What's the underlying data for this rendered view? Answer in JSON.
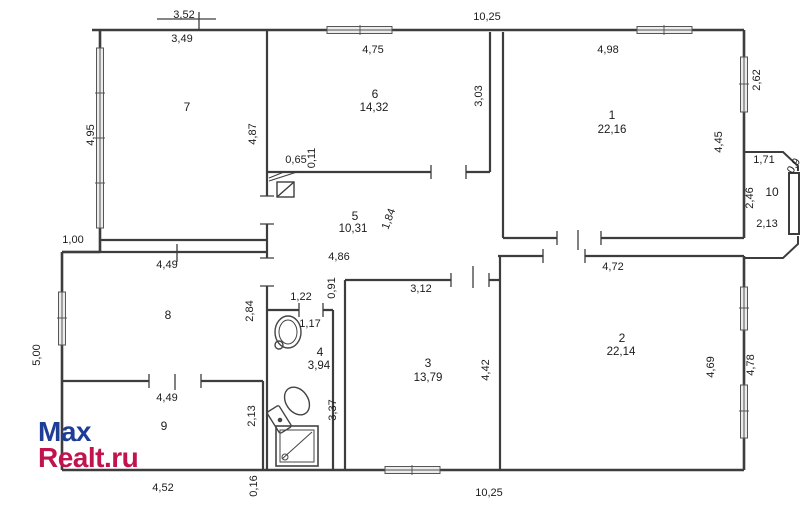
{
  "colors": {
    "wall": "#3d3d3d",
    "label_text": "#1c1c1c",
    "watermark_blue": "#1e3d96",
    "watermark_red": "#c1134e"
  },
  "watermark": {
    "line1": "Max",
    "line2": "Realt.ru"
  },
  "floorplan": {
    "rooms": [
      {
        "number": "1",
        "area": "22,16"
      },
      {
        "number": "2",
        "area": "22,14"
      },
      {
        "number": "3",
        "area": "13,79"
      },
      {
        "number": "4",
        "area": "3,94"
      },
      {
        "number": "5",
        "area": "10,31"
      },
      {
        "number": "6",
        "area": "14,32"
      },
      {
        "number": "7",
        "area": ""
      },
      {
        "number": "8",
        "area": ""
      },
      {
        "number": "9",
        "area": ""
      },
      {
        "number": "10",
        "area": ""
      }
    ],
    "labels": [
      {
        "text": "7",
        "x": 187,
        "y": 107,
        "rot": 0,
        "kind": "room"
      },
      {
        "text": "6",
        "x": 375,
        "y": 94,
        "rot": 0,
        "kind": "room"
      },
      {
        "text": "14,32",
        "x": 374,
        "y": 108,
        "rot": 0,
        "kind": "area"
      },
      {
        "text": "1",
        "x": 612,
        "y": 115,
        "rot": 0,
        "kind": "room"
      },
      {
        "text": "22,16",
        "x": 612,
        "y": 130,
        "rot": 0,
        "kind": "area"
      },
      {
        "text": "5",
        "x": 355,
        "y": 216,
        "rot": 0,
        "kind": "room"
      },
      {
        "text": "10,31",
        "x": 353,
        "y": 229,
        "rot": 0,
        "kind": "area"
      },
      {
        "text": "8",
        "x": 168,
        "y": 315,
        "rot": 0,
        "kind": "room"
      },
      {
        "text": "9",
        "x": 164,
        "y": 426,
        "rot": 0,
        "kind": "room"
      },
      {
        "text": "4",
        "x": 320,
        "y": 352,
        "rot": 0,
        "kind": "room"
      },
      {
        "text": "3,94",
        "x": 319,
        "y": 366,
        "rot": 0,
        "kind": "area"
      },
      {
        "text": "3",
        "x": 428,
        "y": 363,
        "rot": 0,
        "kind": "room"
      },
      {
        "text": "13,79",
        "x": 428,
        "y": 378,
        "rot": 0,
        "kind": "area"
      },
      {
        "text": "2",
        "x": 622,
        "y": 338,
        "rot": 0,
        "kind": "room"
      },
      {
        "text": "22,14",
        "x": 621,
        "y": 352,
        "rot": 0,
        "kind": "area"
      },
      {
        "text": "10",
        "x": 772,
        "y": 192,
        "rot": 0,
        "kind": "room"
      },
      {
        "text": "3,52",
        "x": 184,
        "y": 15,
        "rot": 0,
        "kind": "dim"
      },
      {
        "text": "10,25",
        "x": 487,
        "y": 17,
        "rot": 0,
        "kind": "dim"
      },
      {
        "text": "3,49",
        "x": 182,
        "y": 39,
        "rot": 0,
        "kind": "dim"
      },
      {
        "text": "4,75",
        "x": 373,
        "y": 50,
        "rot": 0,
        "kind": "dim"
      },
      {
        "text": "4,98",
        "x": 608,
        "y": 50,
        "rot": 0,
        "kind": "dim"
      },
      {
        "text": "4,95",
        "x": 91,
        "y": 135,
        "rot": -90,
        "kind": "dim"
      },
      {
        "text": "4,87",
        "x": 253,
        "y": 134,
        "rot": -90,
        "kind": "dim"
      },
      {
        "text": "3,03",
        "x": 479,
        "y": 96,
        "rot": -90,
        "kind": "dim"
      },
      {
        "text": "4,45",
        "x": 719,
        "y": 142,
        "rot": -90,
        "kind": "dim"
      },
      {
        "text": "2,62",
        "x": 757,
        "y": 80,
        "rot": -90,
        "kind": "dim"
      },
      {
        "text": "0,65",
        "x": 296,
        "y": 160,
        "rot": 0,
        "kind": "dim"
      },
      {
        "text": "0,11",
        "x": 312,
        "y": 158,
        "rot": -90,
        "kind": "dim"
      },
      {
        "text": "1,84",
        "x": 389,
        "y": 219,
        "rot": -70,
        "kind": "dim"
      },
      {
        "text": "1,71",
        "x": 764,
        "y": 160,
        "rot": 0,
        "kind": "dim"
      },
      {
        "text": "2,46",
        "x": 750,
        "y": 198,
        "rot": -90,
        "kind": "dim"
      },
      {
        "text": "2,13",
        "x": 767,
        "y": 224,
        "rot": 0,
        "kind": "dim"
      },
      {
        "text": "0,9",
        "x": 794,
        "y": 166,
        "rot": -58,
        "kind": "dim"
      },
      {
        "text": "1,00",
        "x": 73,
        "y": 240,
        "rot": 0,
        "kind": "dim"
      },
      {
        "text": "4,49",
        "x": 167,
        "y": 265,
        "rot": 0,
        "kind": "dim"
      },
      {
        "text": "2,84",
        "x": 250,
        "y": 311,
        "rot": -90,
        "kind": "dim"
      },
      {
        "text": "5,00",
        "x": 37,
        "y": 355,
        "rot": -90,
        "kind": "dim"
      },
      {
        "text": "4,86",
        "x": 339,
        "y": 257,
        "rot": 0,
        "kind": "dim"
      },
      {
        "text": "0,91",
        "x": 332,
        "y": 288,
        "rot": -90,
        "kind": "dim"
      },
      {
        "text": "1,22",
        "x": 301,
        "y": 297,
        "rot": 0,
        "kind": "dim"
      },
      {
        "text": "3,12",
        "x": 421,
        "y": 289,
        "rot": 0,
        "kind": "dim"
      },
      {
        "text": "1,17",
        "x": 310,
        "y": 324,
        "rot": 0,
        "kind": "dim"
      },
      {
        "text": "3,37",
        "x": 333,
        "y": 410,
        "rot": -90,
        "kind": "dim"
      },
      {
        "text": "4,42",
        "x": 486,
        "y": 370,
        "rot": -90,
        "kind": "dim"
      },
      {
        "text": "4,72",
        "x": 613,
        "y": 267,
        "rot": 0,
        "kind": "dim"
      },
      {
        "text": "4,69",
        "x": 711,
        "y": 367,
        "rot": -90,
        "kind": "dim"
      },
      {
        "text": "4,78",
        "x": 751,
        "y": 365,
        "rot": -90,
        "kind": "dim"
      },
      {
        "text": "4,49",
        "x": 167,
        "y": 398,
        "rot": 0,
        "kind": "dim"
      },
      {
        "text": "2,13",
        "x": 252,
        "y": 416,
        "rot": -90,
        "kind": "dim"
      },
      {
        "text": "4,52",
        "x": 163,
        "y": 488,
        "rot": 0,
        "kind": "dim"
      },
      {
        "text": "0,16",
        "x": 254,
        "y": 486,
        "rot": -90,
        "kind": "dim"
      },
      {
        "text": "10,25",
        "x": 489,
        "y": 493,
        "rot": 0,
        "kind": "dim"
      }
    ]
  }
}
